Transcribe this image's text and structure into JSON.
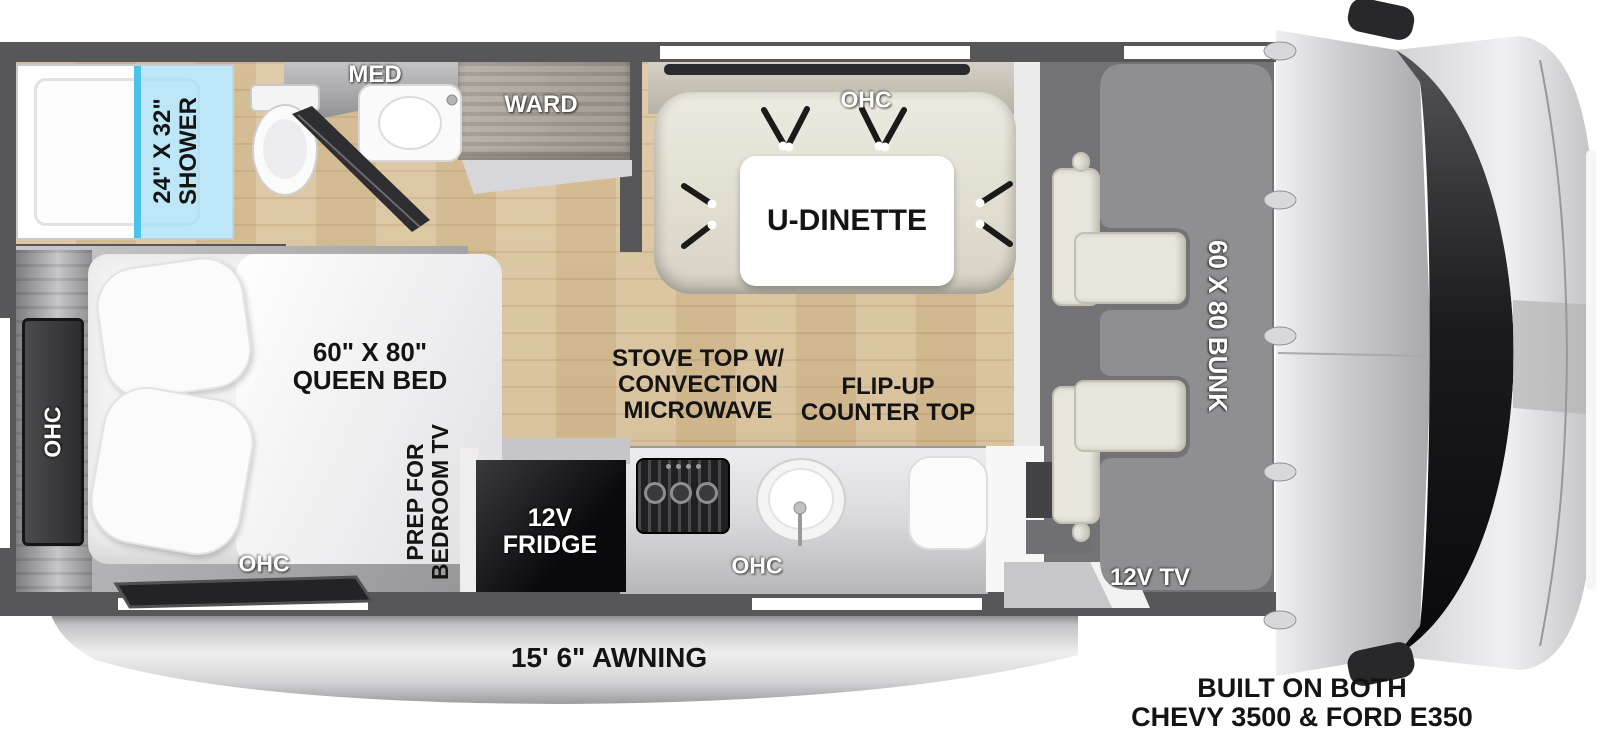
{
  "colors": {
    "wall": "#57575a",
    "floor_wood": "#d8c098",
    "floor_bedroom": "#b2b2b4",
    "shower_glass": "#a9e0f4",
    "bunk_gray": "#8f8f92",
    "cab_floor": "#737376",
    "seat_cream": "#e9e6dc",
    "fridge_black": "#0a0a0c",
    "awning_silver": "#d9d9db",
    "label_black": "#141414",
    "label_white": "#ffffff"
  },
  "bathroom": {
    "shower_size": "24\" X 32\"",
    "shower_label": "SHOWER",
    "med_label": "MED",
    "ward_label": "WARD"
  },
  "dinette": {
    "ohc_label": "OHC",
    "table_label": "U-DINETTE"
  },
  "kitchen": {
    "stove_label_line1": "STOVE TOP W/",
    "stove_label_line2": "CONVECTION",
    "stove_label_line3": "MICROWAVE",
    "flip_counter_line1": "FLIP-UP",
    "flip_counter_line2": "COUNTER TOP",
    "fridge_line1": "12V",
    "fridge_line2": "FRIDGE",
    "ohc_label": "OHC"
  },
  "bedroom": {
    "bed_size": "60\" X 80\"",
    "bed_label": "QUEEN BED",
    "ohc_left_label": "OHC",
    "ohc_bottom_label": "OHC",
    "tv_prep_line1": "PREP FOR",
    "tv_prep_line2": "BEDROOM TV"
  },
  "cab": {
    "bunk_label": "60 X 80 BUNK",
    "tv_label": "12V TV"
  },
  "exterior": {
    "awning_label": "15' 6\" AWNING",
    "chassis_line1": "BUILT ON BOTH",
    "chassis_line2": "CHEVY 3500 & FORD E350"
  }
}
